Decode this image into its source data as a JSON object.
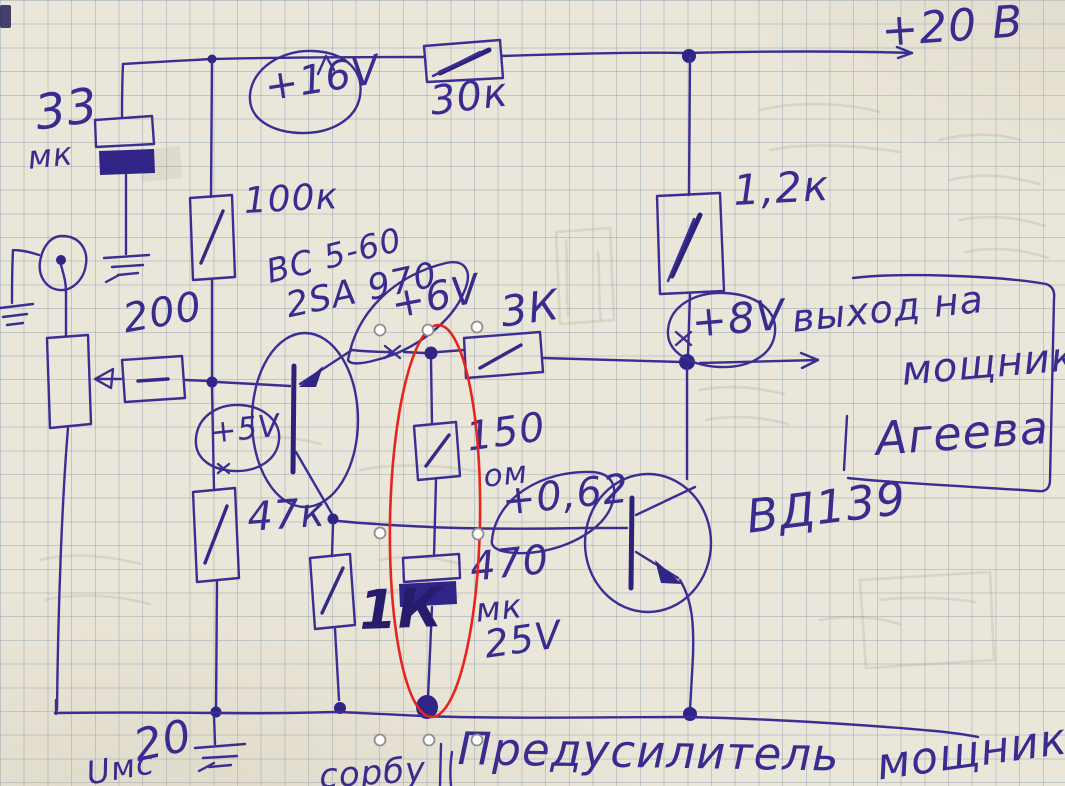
{
  "colors": {
    "ink": "#3b2e92",
    "ink_bold": "#261c6b",
    "highlight_red": "#e6251f",
    "paper": "#eae6d9",
    "grid_line": "#7a94a8",
    "pencil_ghost": "#8d8574"
  },
  "schematic": {
    "power_rail": {
      "supply_voltage": "+20 В",
      "series_resistor": "30к",
      "node_voltage": "+16V"
    },
    "input": {
      "cap_value": "33",
      "cap_unit": "мк",
      "bias_resistor": "100к",
      "feed_resistor": "200"
    },
    "q1": {
      "part_line1": "BC 5-60",
      "part_line2": "2SA 970",
      "base_voltage": "+5V",
      "emitter_voltage": "+6V",
      "lower_resistor": "47к",
      "load_resistor": "1К"
    },
    "mid": {
      "resistor_3k": "3К",
      "r150_value": "150",
      "r150_unit": "ом",
      "vbe_annotation": "+0,62",
      "cap_value": "470",
      "cap_unit": "мк",
      "cap_voltage": "25V"
    },
    "q2": {
      "part": "ВД139",
      "collector_resistor": "1,2к",
      "node_voltage": "+8V"
    },
    "output": {
      "line1": "выход на",
      "line2": "мощник",
      "line3": "Агеева"
    },
    "bottom": {
      "title": "Предусилитель",
      "title2": "мощника",
      "input_label": "Uмс",
      "input_value": "20",
      "partial_word": "сорбу"
    }
  }
}
